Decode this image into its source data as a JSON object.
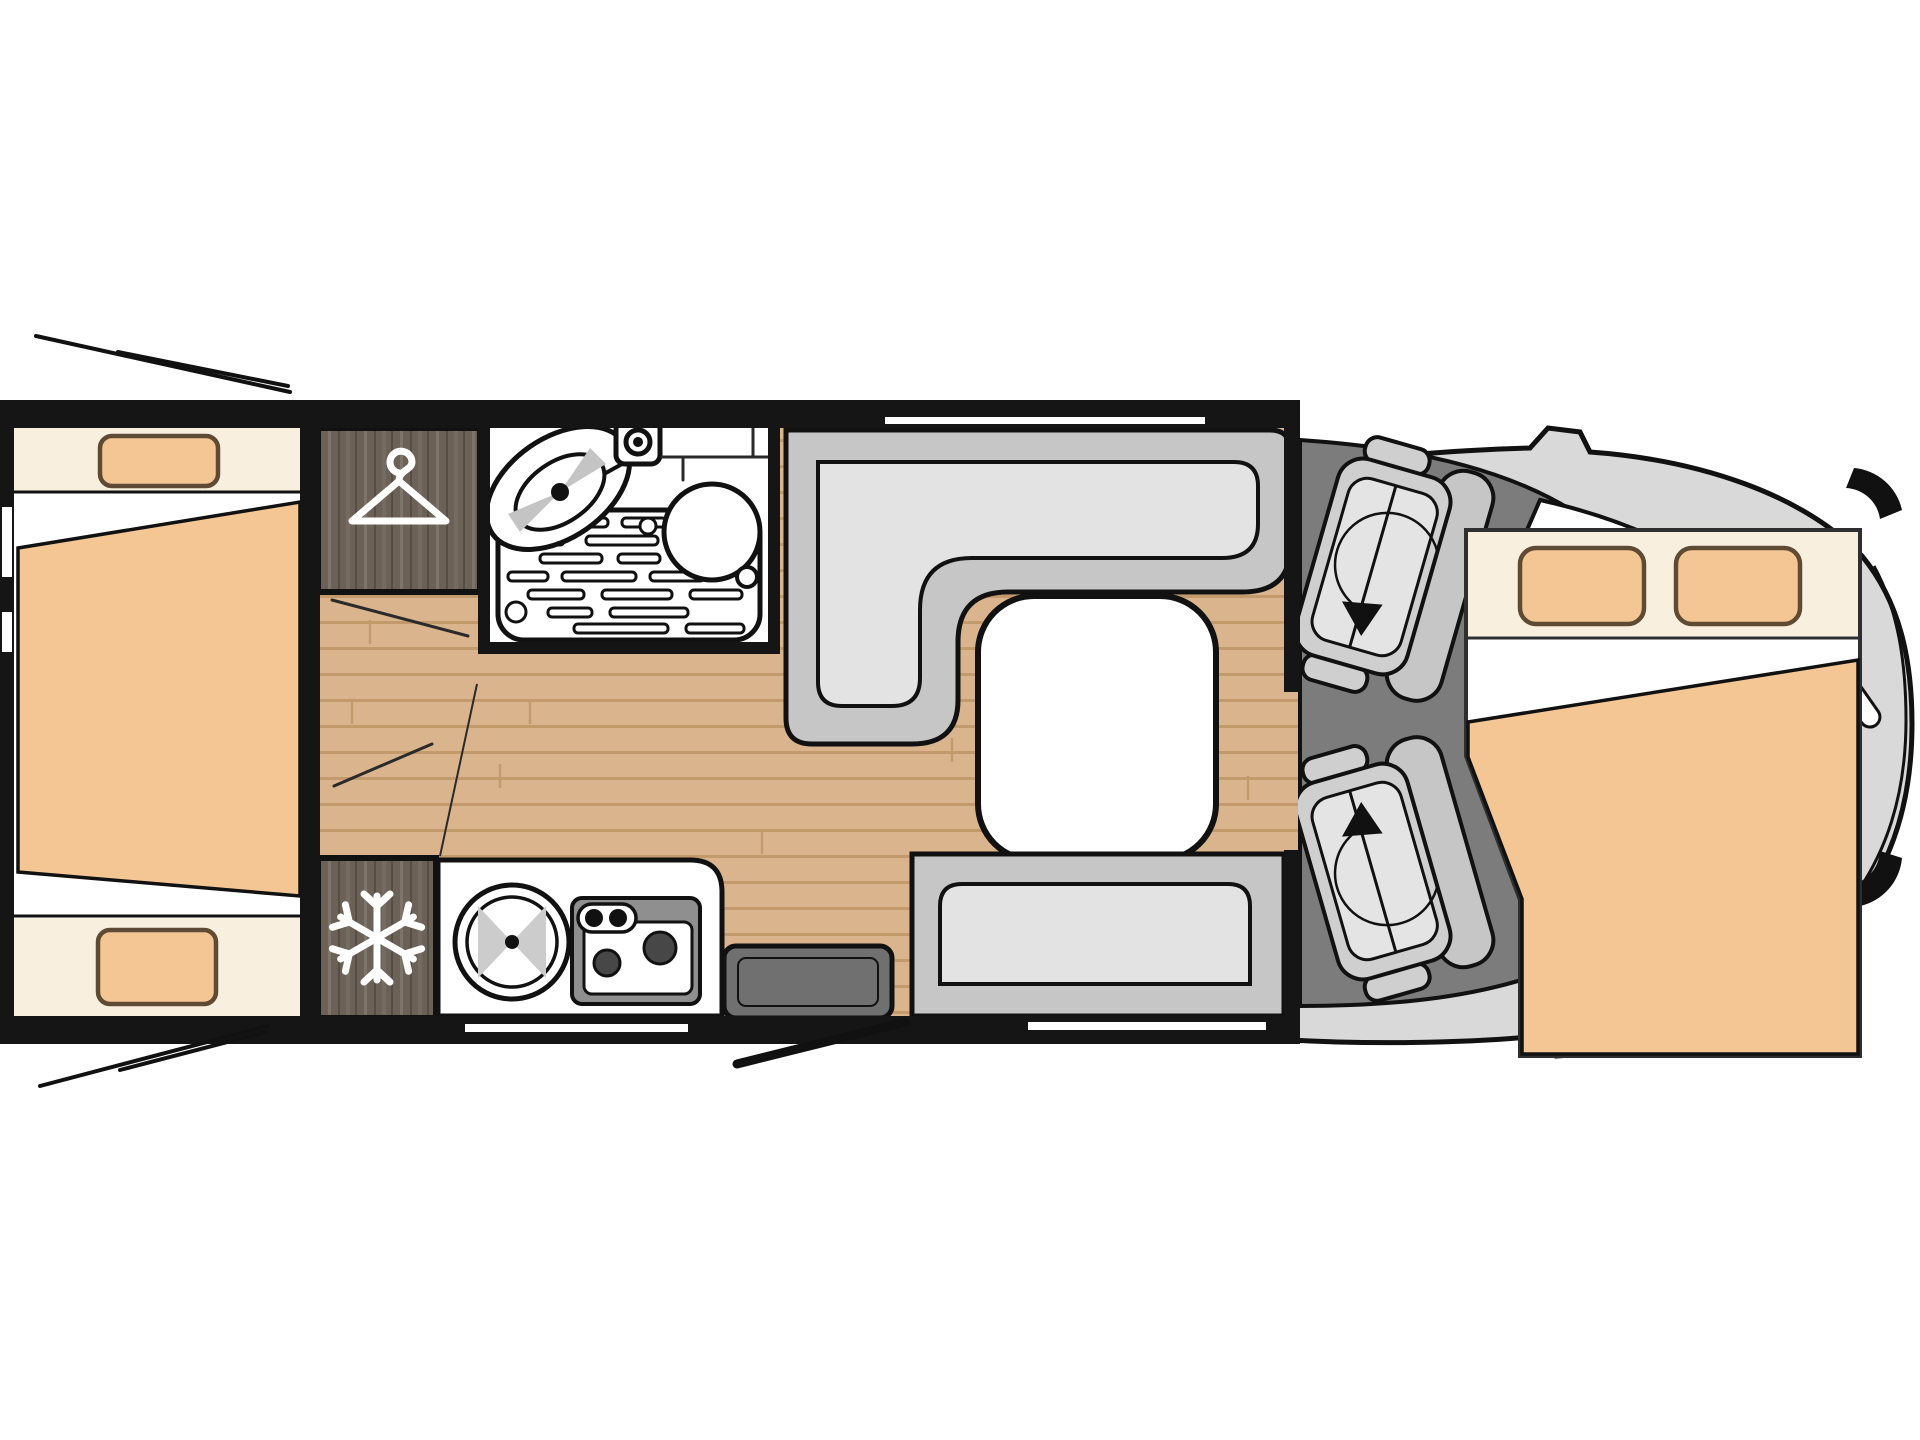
{
  "page": {
    "title": "Motorhome floor plan (top view)"
  },
  "floor_plan": {
    "vehicle_type": "motorhome",
    "view": "top-down",
    "front_direction": "right",
    "areas": [
      {
        "id": "rear-bedroom",
        "label": "Rear bedroom with two single beds and wedge mattress"
      },
      {
        "id": "wardrobe",
        "label": "Wardrobe cabinet"
      },
      {
        "id": "bathroom",
        "label": "Bathroom with washbasin, toilet and shower tray"
      },
      {
        "id": "fridge",
        "label": "Refrigerator cabinet"
      },
      {
        "id": "kitchen",
        "label": "Kitchen block with round sink and two-burner hob"
      },
      {
        "id": "dinette",
        "label": "L-shaped dinette bench with table"
      },
      {
        "id": "side-bench",
        "label": "Side bench seat"
      },
      {
        "id": "entrance",
        "label": "Entrance door with step"
      },
      {
        "id": "cab",
        "label": "Driver cab with two swivel seats"
      },
      {
        "id": "drop-down-bed",
        "label": "Drop-down double bed over the cab"
      }
    ],
    "icons": [
      {
        "name": "hanger-icon",
        "meaning": "wardrobe"
      },
      {
        "name": "snowflake-icon",
        "meaning": "refrigerator"
      },
      {
        "name": "swivel-arrow-icon",
        "meaning": "rotating cab seat"
      },
      {
        "name": "burner-icon",
        "meaning": "gas hob burner"
      }
    ],
    "colors": {
      "wall": "#151515",
      "outline": "#111111",
      "floor": "#d9b48c",
      "floor-line": "#c29a6c",
      "darkwood": "#6b6156",
      "darkwood-grain": "#7d746a",
      "darkwood-dark": "#564d44",
      "cream": "#f9efdf",
      "mattress": "#f4c694",
      "pillow-outline": "#5f4a33",
      "bench-outer": "#c6c6c6",
      "bench-cushion": "#e3e3e3",
      "cab-body": "#d9d9d9",
      "cab-floor": "#7c7c7c",
      "entry-step": "#707070",
      "stove-frame": "#8f8f8f",
      "burner": "#474747"
    }
  }
}
